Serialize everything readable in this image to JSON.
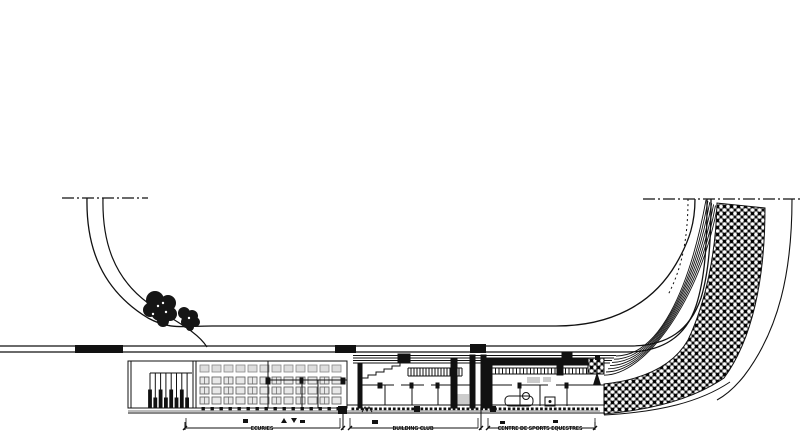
{
  "page": {
    "width": 800,
    "height": 435,
    "background": "#ffffff"
  },
  "colors": {
    "ink": "#111111",
    "gray_light": "#e8e8e8",
    "gray_mid": "#bbbbbb",
    "gray_dark": "#666666",
    "furniture_fill": "#dddddd",
    "tree_fill": "#161616",
    "hatch_gray": "#6e6e6e"
  },
  "plan": {
    "type": "architectural-site-plan",
    "dimension_segments": [
      {
        "label": "ECURIES"
      },
      {
        "label": "BUILDING CLUB"
      },
      {
        "label": "CENTRE DE SPORTS EQUESTRES"
      }
    ]
  }
}
